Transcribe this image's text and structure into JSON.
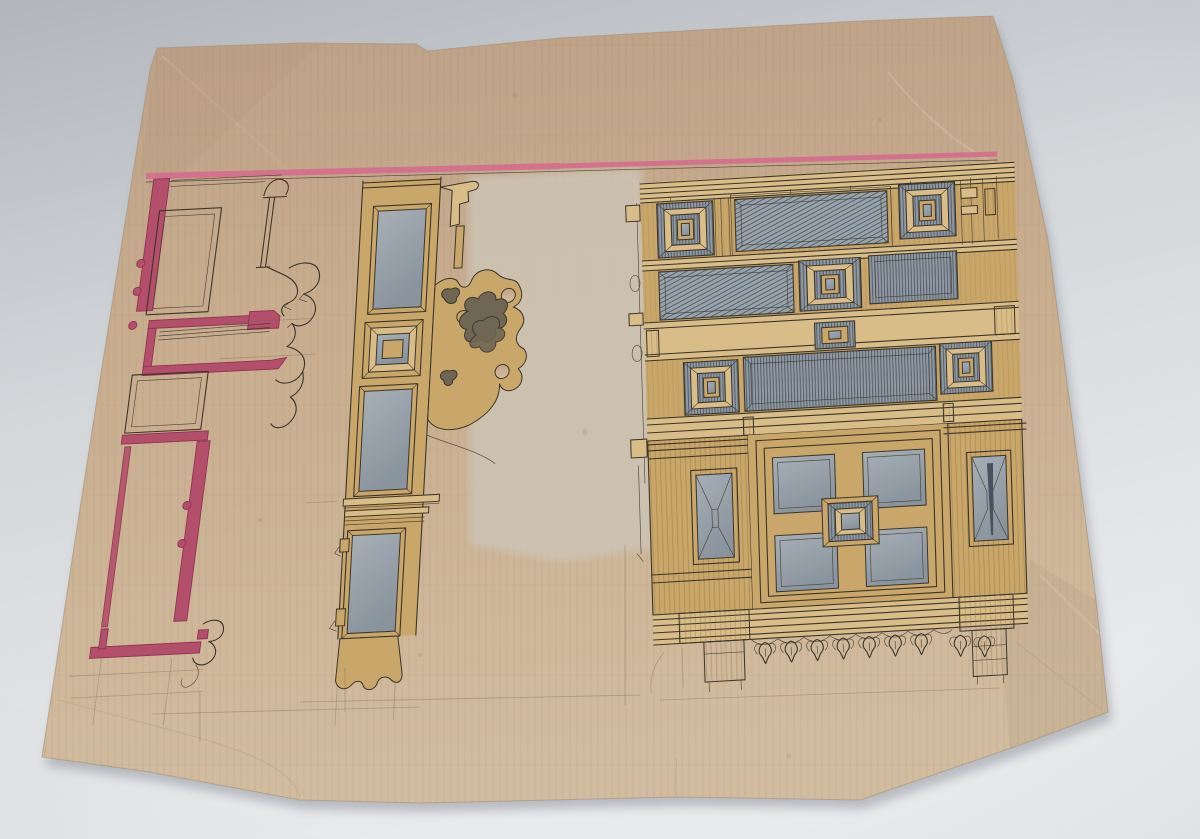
{
  "scene": {
    "kind": "photograph-of-hand-drawn-architectural-design",
    "sheet": "aged tan drawing paper, torn edges, photographed on pale grey surface",
    "views": {
      "plan": "plan section of panelled wall and doorway washed in carmine",
      "stile": "elevation of glazed door stile with carved leaf bracket",
      "elevation": "elevation of carved wood panelling with pyramid bosses and pendant cresting"
    },
    "ruled_line": "pink ruled line across top of sheet"
  },
  "colors": {
    "bg_top": "#b2b6bc",
    "bg_mid": "#d4d7da",
    "bg_low": "#e9eaec",
    "paper": "#c8ad8e",
    "paper_top": "#bda188",
    "paper_low": "#d2bc9f",
    "paper_dark": "#a98e74",
    "paper_grain": "#8e7458",
    "pale_patch": "#cdc4b5",
    "pink": "#d4718c",
    "crimson": "#b44f6b",
    "crimson_dark": "#8e3350",
    "ochre": "#c9a76a",
    "ochre_light": "#d8bd89",
    "ochre_dark": "#8f6f3c",
    "panel_gray": "#8f99a3",
    "panel_gray2": "#99a3ac",
    "glass_a": "#a6afb6",
    "glass_b": "#8a949e",
    "hatch_line": "#49525c",
    "ink": "#3c352a",
    "pencil": "#6f6454",
    "leaf_dark": "#6f6754",
    "stain": "#8a6b4a",
    "shadow": "#878d96"
  }
}
